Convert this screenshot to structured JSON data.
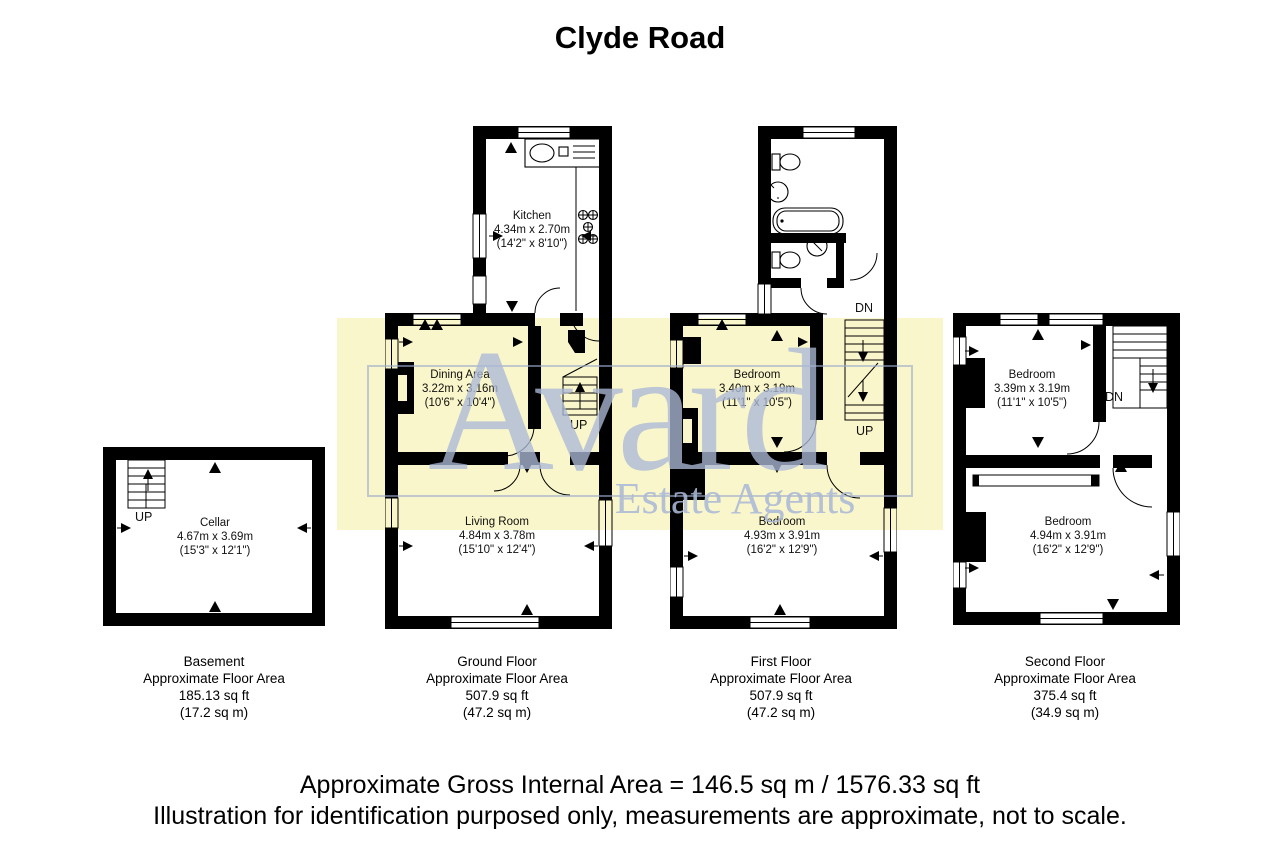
{
  "title": "Clyde Road",
  "watermark": {
    "name": "Avard",
    "subtitle": "Estate Agents",
    "bg_color": "#FAF6CB",
    "text_color": "#AAB8D6"
  },
  "plans": {
    "basement": {
      "rooms": {
        "cellar": {
          "name": "Cellar",
          "metric": "4.67m x 3.69m",
          "imperial": "(15'3\" x 12'1\")"
        }
      },
      "stairs_up": "UP",
      "caption": {
        "floor": "Basement",
        "line": "Approximate Floor Area",
        "area_ft": "185.13 sq ft",
        "area_m": "(17.2 sq m)"
      }
    },
    "ground": {
      "rooms": {
        "kitchen": {
          "name": "Kitchen",
          "metric": "4.34m x 2.70m",
          "imperial": "(14'2\" x 8'10\")"
        },
        "dining": {
          "name": "Dining Area",
          "metric": "3.22m x 3.16m",
          "imperial": "(10'6\" x 10'4\")"
        },
        "living": {
          "name": "Living Room",
          "metric": "4.84m x 3.78m",
          "imperial": "(15'10\" x 12'4\")"
        }
      },
      "stairs_up": "UP",
      "caption": {
        "floor": "Ground Floor",
        "line": "Approximate Floor Area",
        "area_ft": "507.9 sq ft",
        "area_m": "(47.2 sq m)"
      }
    },
    "first": {
      "rooms": {
        "bedroom1": {
          "name": "Bedroom",
          "metric": "3.40m x 3.19m",
          "imperial": "(11'1\" x 10'5\")"
        },
        "bedroom2": {
          "name": "Bedroom",
          "metric": "4.93m x 3.91m",
          "imperial": "(16'2\" x 12'9\")"
        }
      },
      "stairs_up": "UP",
      "stairs_dn": "DN",
      "caption": {
        "floor": "First Floor",
        "line": "Approximate Floor Area",
        "area_ft": "507.9 sq ft",
        "area_m": "(47.2 sq m)"
      }
    },
    "second": {
      "rooms": {
        "bedroom1": {
          "name": "Bedroom",
          "metric": "3.39m x 3.19m",
          "imperial": "(11'1\" x 10'5\")"
        },
        "bedroom2": {
          "name": "Bedroom",
          "metric": "4.94m x 3.91m",
          "imperial": "(16'2\" x 12'9\")"
        }
      },
      "stairs_dn": "DN",
      "caption": {
        "floor": "Second Floor",
        "line": "Approximate Floor Area",
        "area_ft": "375.4 sq ft",
        "area_m": "(34.9 sq m)"
      }
    }
  },
  "footer": {
    "line1": "Approximate Gross Internal Area = 146.5 sq m / 1576.33 sq ft",
    "line2": "Illustration for identification purposed only, measurements are approximate, not to scale."
  }
}
